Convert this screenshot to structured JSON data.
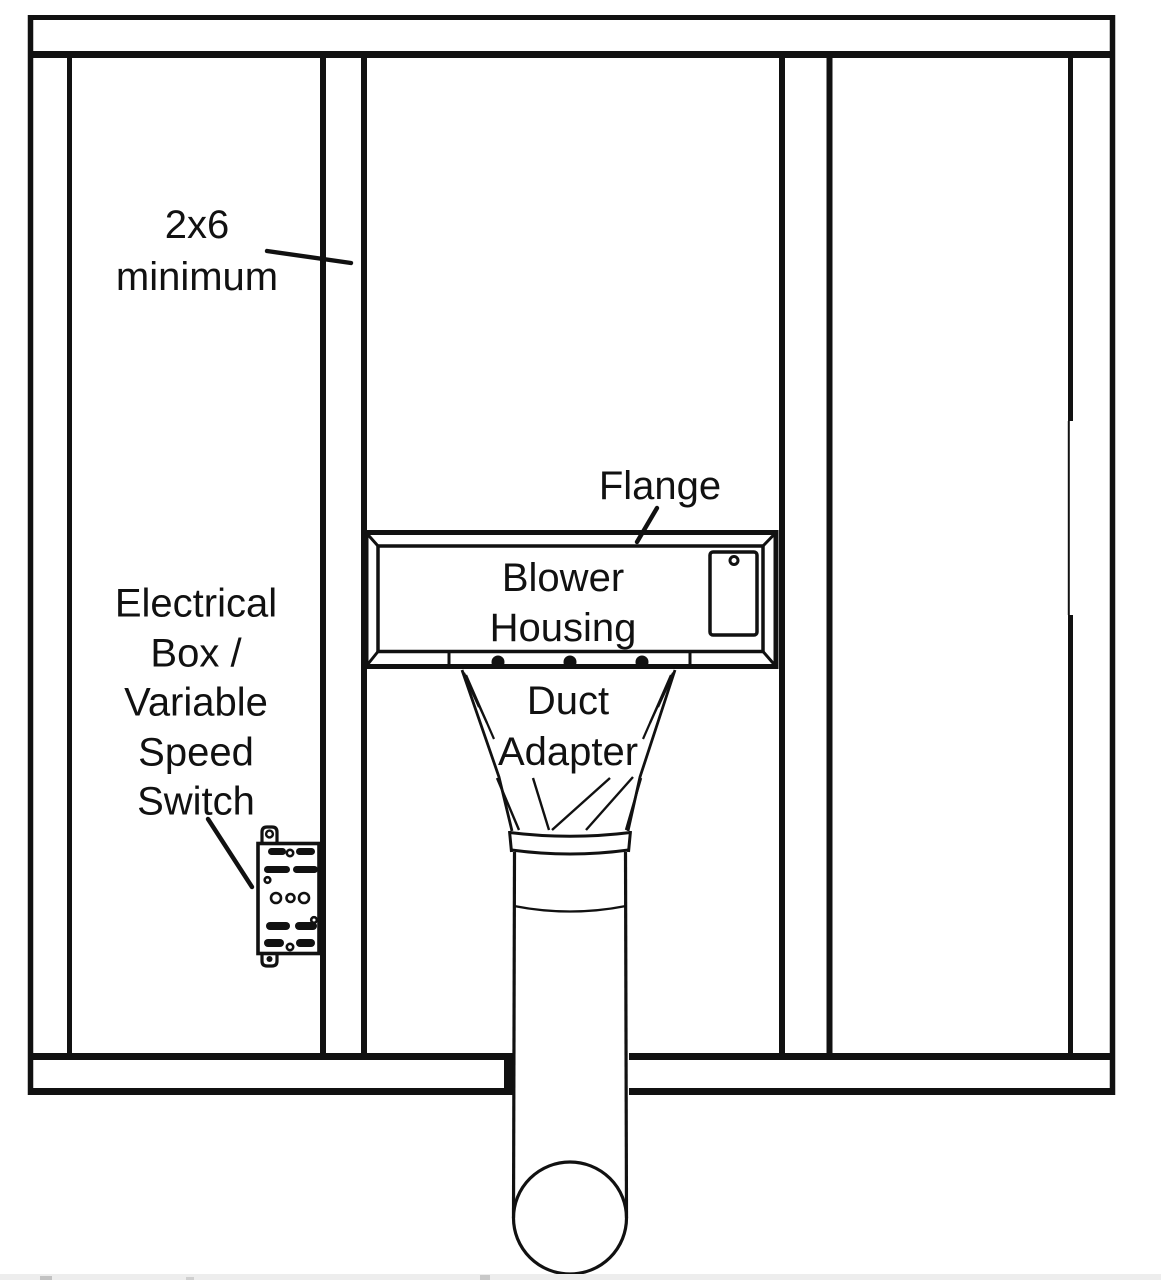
{
  "diagram": {
    "description_colors": {
      "ink": "#111111",
      "paper": "#ffffff",
      "artifact_strip": "#ededed"
    },
    "labels": {
      "stud_note": [
        "2x6",
        "minimum"
      ],
      "flange": "Flange",
      "blower_housing": [
        "Blower",
        "Housing"
      ],
      "duct_adapter": [
        "Duct",
        "Adapter"
      ],
      "electrical_switch": [
        "Electrical",
        "Box /",
        "Variable",
        "Speed",
        "Switch"
      ]
    }
  }
}
